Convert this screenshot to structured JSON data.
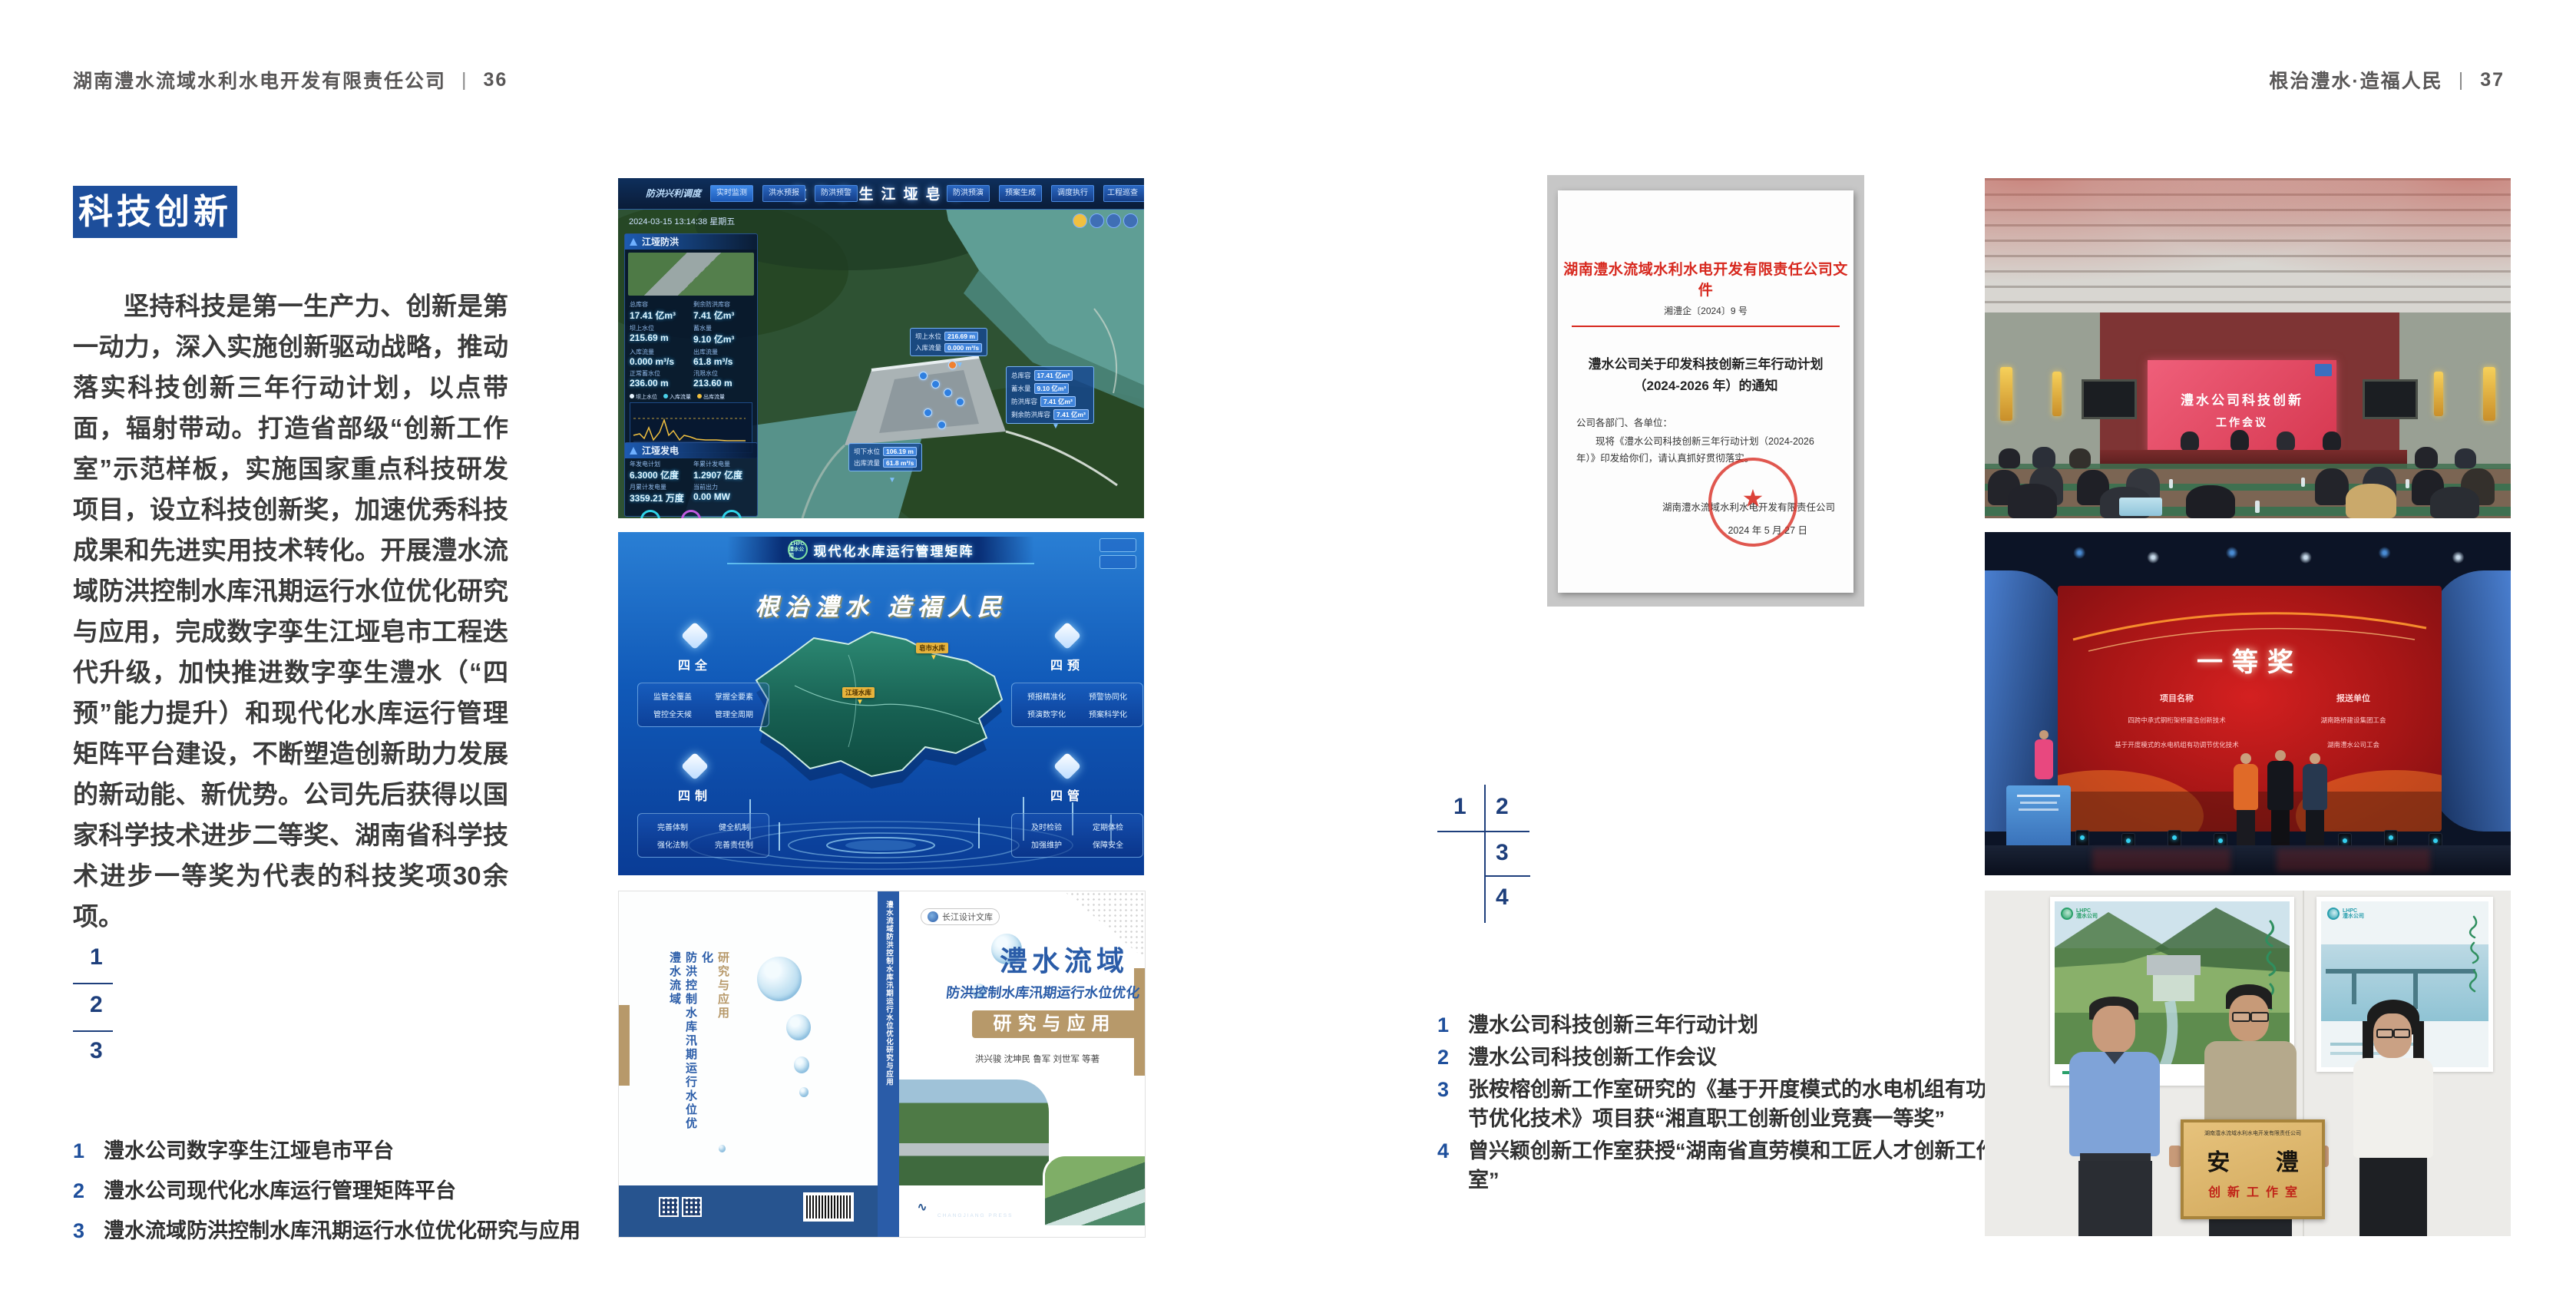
{
  "colors": {
    "accent_blue": "#1d4e9b",
    "caption_blue": "#1e4f9c",
    "doc_red": "#d7281e",
    "band_tan": "#b7996a",
    "navy_band": "#27548f"
  },
  "header_left": {
    "company": "湖南澧水流域水利水电开发有限责任公司",
    "sep": "|",
    "page": "36"
  },
  "header_right": {
    "slogan": "根治澧水·造福人民",
    "sep": "|",
    "page": "37"
  },
  "left_page": {
    "section_title": "科技创新",
    "paragraph": "坚持科技是第一生产力、创新是第一动力，深入实施创新驱动战略，推动落实科技创新三年行动计划，以点带面，辐射带动。打造省部级“创新工作室”示范样板，实施国家重点科技研发项目，设立科技创新奖，加速优秀科技成果和先进实用技术转化。开展澧水流域防洪控制水库汛期运行水位优化研究与应用，完成数字孪生江垭皂市工程迭代升级，加快推进数字孪生澧水（“四预”能力提升）和现代化水库运行管理矩阵平台建设，不断塑造创新助力发展的新动能、新优势。公司先后获得以国家科学技术进步二等奖、湖南省科学技术进步一等奖为代表的科技奖项30余项。",
    "figure_index": [
      "1",
      "2",
      "3"
    ],
    "captions": [
      {
        "num": "1",
        "text": "澧水公司数字孪生江垭皂市平台"
      },
      {
        "num": "2",
        "text": "澧水公司现代化水库运行管理矩阵平台"
      },
      {
        "num": "3",
        "text": "澧水流域防洪控制水库汛期运行水位优化研究与应用"
      }
    ]
  },
  "right_page": {
    "figure_index": [
      "1",
      "2",
      "3",
      "4"
    ],
    "captions": [
      {
        "num": "1",
        "text": "澧水公司科技创新三年行动计划"
      },
      {
        "num": "2",
        "text": "澧水公司科技创新工作会议"
      },
      {
        "num": "3",
        "text": "张桉榕创新工作室研究的《基于开度模式的水电机组有功调节优化技术》项目获“湘直职工创新创业竞赛一等奖”"
      },
      {
        "num": "4",
        "text": "曾兴颖创新工作室获授“湖南省直劳模和工匠人才创新工作室”"
      }
    ]
  },
  "dashboard": {
    "title": "数字孪生江垭皂市",
    "mode_label": "防洪兴利调度",
    "tabs_left": [
      "实时监测",
      "洪水预报",
      "防洪预警"
    ],
    "tabs_right": [
      "防洪预演",
      "预案生成",
      "调度执行",
      "工程巡查"
    ],
    "datetime": "2024-03-15 13:14:38 星期五",
    "legend": [
      "坝上水位",
      "入库流量",
      "出库流量"
    ],
    "panel1": {
      "title": "江垭防洪",
      "stats": [
        {
          "l": "总库容",
          "v": "17.41 亿m³"
        },
        {
          "l": "剩余防洪库容",
          "v": "7.41 亿m³"
        },
        {
          "l": "坝上水位",
          "v": "215.69 m"
        },
        {
          "l": "蓄水量",
          "v": "9.10 亿m³"
        },
        {
          "l": "入库流量",
          "v": "0.000 m³/s"
        },
        {
          "l": "出库流量",
          "v": "61.8 m³/s"
        },
        {
          "l": "正常蓄水位",
          "v": "236.00 m"
        },
        {
          "l": "汛限水位",
          "v": "213.60 m"
        }
      ]
    },
    "panel2": {
      "title": "江垭发电",
      "stats": [
        {
          "l": "年发电计划",
          "v": "6.3000 亿度"
        },
        {
          "l": "年累计发电量",
          "v": "1.2907 亿度"
        },
        {
          "l": "月累计发电量",
          "v": "3359.21 万度"
        },
        {
          "l": "当前出力",
          "v": "0.00 MW"
        },
        {
          "l": "发电流量",
          "v": "0.00 m³/s"
        },
        {
          "l": "泄水流量",
          "v": "0.00 m³/s"
        }
      ],
      "gauges": [
        "0.00",
        "100.98",
        "0.00"
      ]
    },
    "callout1": {
      "rows": [
        {
          "l": "坝上水位",
          "v": "216.69 m"
        },
        {
          "l": "入库流量",
          "v": "0.000 m³/s"
        }
      ]
    },
    "callout2": {
      "rows": [
        {
          "l": "总库容",
          "v": "17.41 亿m³"
        },
        {
          "l": "蓄水量",
          "v": "9.10 亿m³"
        },
        {
          "l": "防洪库容",
          "v": "7.41 亿m³"
        },
        {
          "l": "剩余防洪库容",
          "v": "7.41 亿m³"
        }
      ]
    },
    "callout3": {
      "rows": [
        {
          "l": "坝下水位",
          "v": "106.19 m"
        },
        {
          "l": "出库流量",
          "v": "61.8 m³/s"
        }
      ]
    }
  },
  "matrix": {
    "logo_top": "LHPC",
    "logo_sub": "澧水公司",
    "header_title": "现代化水库运行管理矩阵",
    "slogan": "根治澧水  造福人民",
    "groups": [
      {
        "title": "四全",
        "items": [
          "监管全覆盖",
          "掌握全要素",
          "管控全天候",
          "管理全周期"
        ]
      },
      {
        "title": "四预",
        "items": [
          "预报精准化",
          "预警协同化",
          "预演数字化",
          "预案科学化"
        ]
      },
      {
        "title": "四制",
        "items": [
          "完善体制",
          "健全机制",
          "强化法制",
          "完善责任制"
        ]
      },
      {
        "title": "四管",
        "items": [
          "及时检验",
          "定期体检",
          "加强维护",
          "保障安全"
        ]
      }
    ],
    "map_labels": [
      "皂市水库",
      "江垭水库"
    ]
  },
  "book": {
    "series": "长江设计文库",
    "title_main": "澧水流域",
    "title_sub": "防洪控制水库汛期运行水位优化",
    "title_band": "研究与应用",
    "authors": "洪兴骏  沈坤民  鲁军  刘世军  等著",
    "publisher": "长江出版社",
    "publisher_sub": "CHANGJIANG PRESS",
    "spine_text": "澧水流域防洪控制水库汛期运行水位优化研究与应用",
    "back_lines": [
      "澧水流域",
      "防洪控制水库汛期运行水位优化",
      "研究与应用"
    ]
  },
  "document": {
    "header": "湖南澧水流域水利水电开发有限责任公司文件",
    "doc_no": "湘澧企〔2024〕9 号",
    "title1": "澧水公司关于印发科技创新三年行动计划",
    "title2": "（2024-2026 年）的通知",
    "salutation": "公司各部门、各单位：",
    "body": "现将《澧水公司科技创新三年行动计划（2024-2026 年）》印发给你们，请认真抓好贯彻落实。",
    "signer": "湖南澧水流域水利水电开发有限责任公司",
    "date": "2024 年 5 月 27 日"
  },
  "meeting": {
    "screen_title": "澧水公司科技创新",
    "screen_subtitle": "工作会议"
  },
  "award": {
    "screen_title": "一等奖",
    "col1_header": "项目名称",
    "col2_header": "报送单位",
    "col1_rows": [
      "四跨中承式钢桁架桥建造创新技术",
      "基于开度模式的水电机组有功调节优化技术"
    ],
    "col2_rows": [
      "湖南路桥建设集团工会",
      "湖南澧水公司工会"
    ]
  },
  "group_photo": {
    "poster_logo": "LHPC",
    "poster_logo_sub": "澧水公司",
    "plaque_org": "湖南澧水流域水利水电开发有限责任公司",
    "plaque_name": "安 澧",
    "plaque_sub": "创新工作室"
  }
}
